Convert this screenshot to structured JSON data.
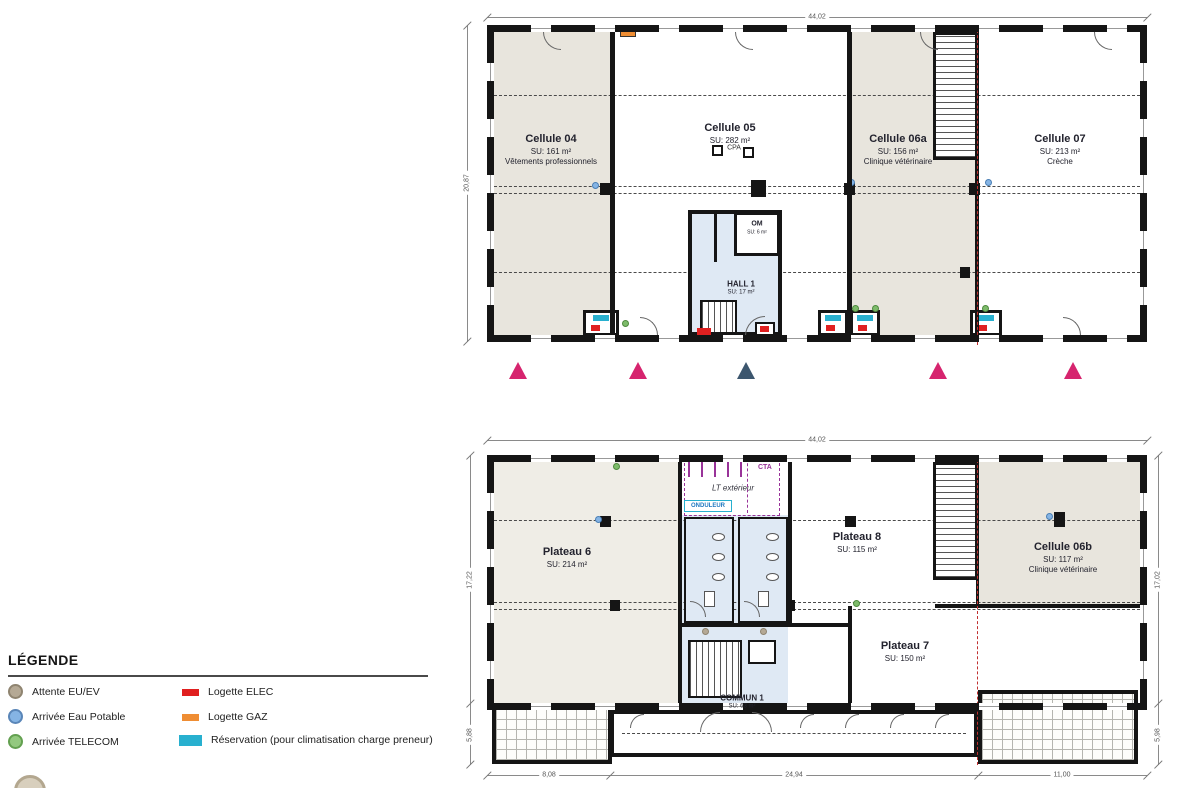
{
  "colors": {
    "wall": "#151515",
    "room_beige": "#e8e5dd",
    "room_light_beige": "#efede6",
    "room_blue": "#dfe9f4",
    "entry_marker_pink": "#d6246e",
    "entry_marker_navy": "#3c566e",
    "logette_elec_red": "#e01f1f",
    "logette_gaz_orange": "#ef8d33",
    "reservation_cyan": "#28b0cf",
    "attente_euev_taupe": "#b5a995",
    "eau_potable_blue": "#85b4e4",
    "telecom_green": "#93c97f",
    "joint_line_red": "#c03030",
    "cta_purple": "#993399"
  },
  "legend": {
    "title": "LÉGENDE",
    "items_left": [
      {
        "label": "Attente EU/EV"
      },
      {
        "label": "Arrivée Eau Potable"
      },
      {
        "label": "Arrivée TELECOM"
      }
    ],
    "items_right": [
      {
        "label": "Logette ELEC"
      },
      {
        "label": "Logette GAZ"
      },
      {
        "label": "Réservation (pour climatisation charge preneur)"
      }
    ]
  },
  "plan_upper": {
    "rooms": [
      {
        "name": "Cellule 04",
        "su": "SU: 161 m²",
        "sub": "Vêtements professionnels"
      },
      {
        "name": "Cellule 05",
        "su": "SU: 282 m²",
        "sub": ""
      },
      {
        "name": "Cellule 06a",
        "su": "SU: 156 m²",
        "sub": "Clinique vétérinaire"
      },
      {
        "name": "Cellule 07",
        "su": "SU: 213 m²",
        "sub": "Crèche"
      }
    ],
    "hall": {
      "name": "HALL 1",
      "su": "SU: 17 m²"
    },
    "om": {
      "name": "OM",
      "su": "SU: 6 m²"
    },
    "cpa": "CPA",
    "dims": {
      "top": "44,02",
      "left": "20,87"
    }
  },
  "plan_lower": {
    "rooms": [
      {
        "name": "Plateau 6",
        "su": "SU: 214 m²"
      },
      {
        "name": "Plateau 8",
        "su": "SU: 115 m²"
      },
      {
        "name": "Cellule 06b",
        "su": "SU: 117 m²",
        "sub": "Clinique vétérinaire"
      },
      {
        "name": "Plateau 7",
        "su": "SU: 150 m²"
      },
      {
        "name": "COMMUN 1",
        "su": "SU: 63 m²"
      }
    ],
    "annotations": {
      "cta": "CTA",
      "lt_exterieur": "LT extérieur",
      "onduleur": "ONDULEUR"
    },
    "dims": {
      "top": "44,02",
      "left_main": "17,22",
      "left_low": "5,88",
      "right_main": "17,02",
      "right_low": "5,98",
      "bottom": [
        "8,08",
        "24,94",
        "11,00"
      ]
    }
  }
}
